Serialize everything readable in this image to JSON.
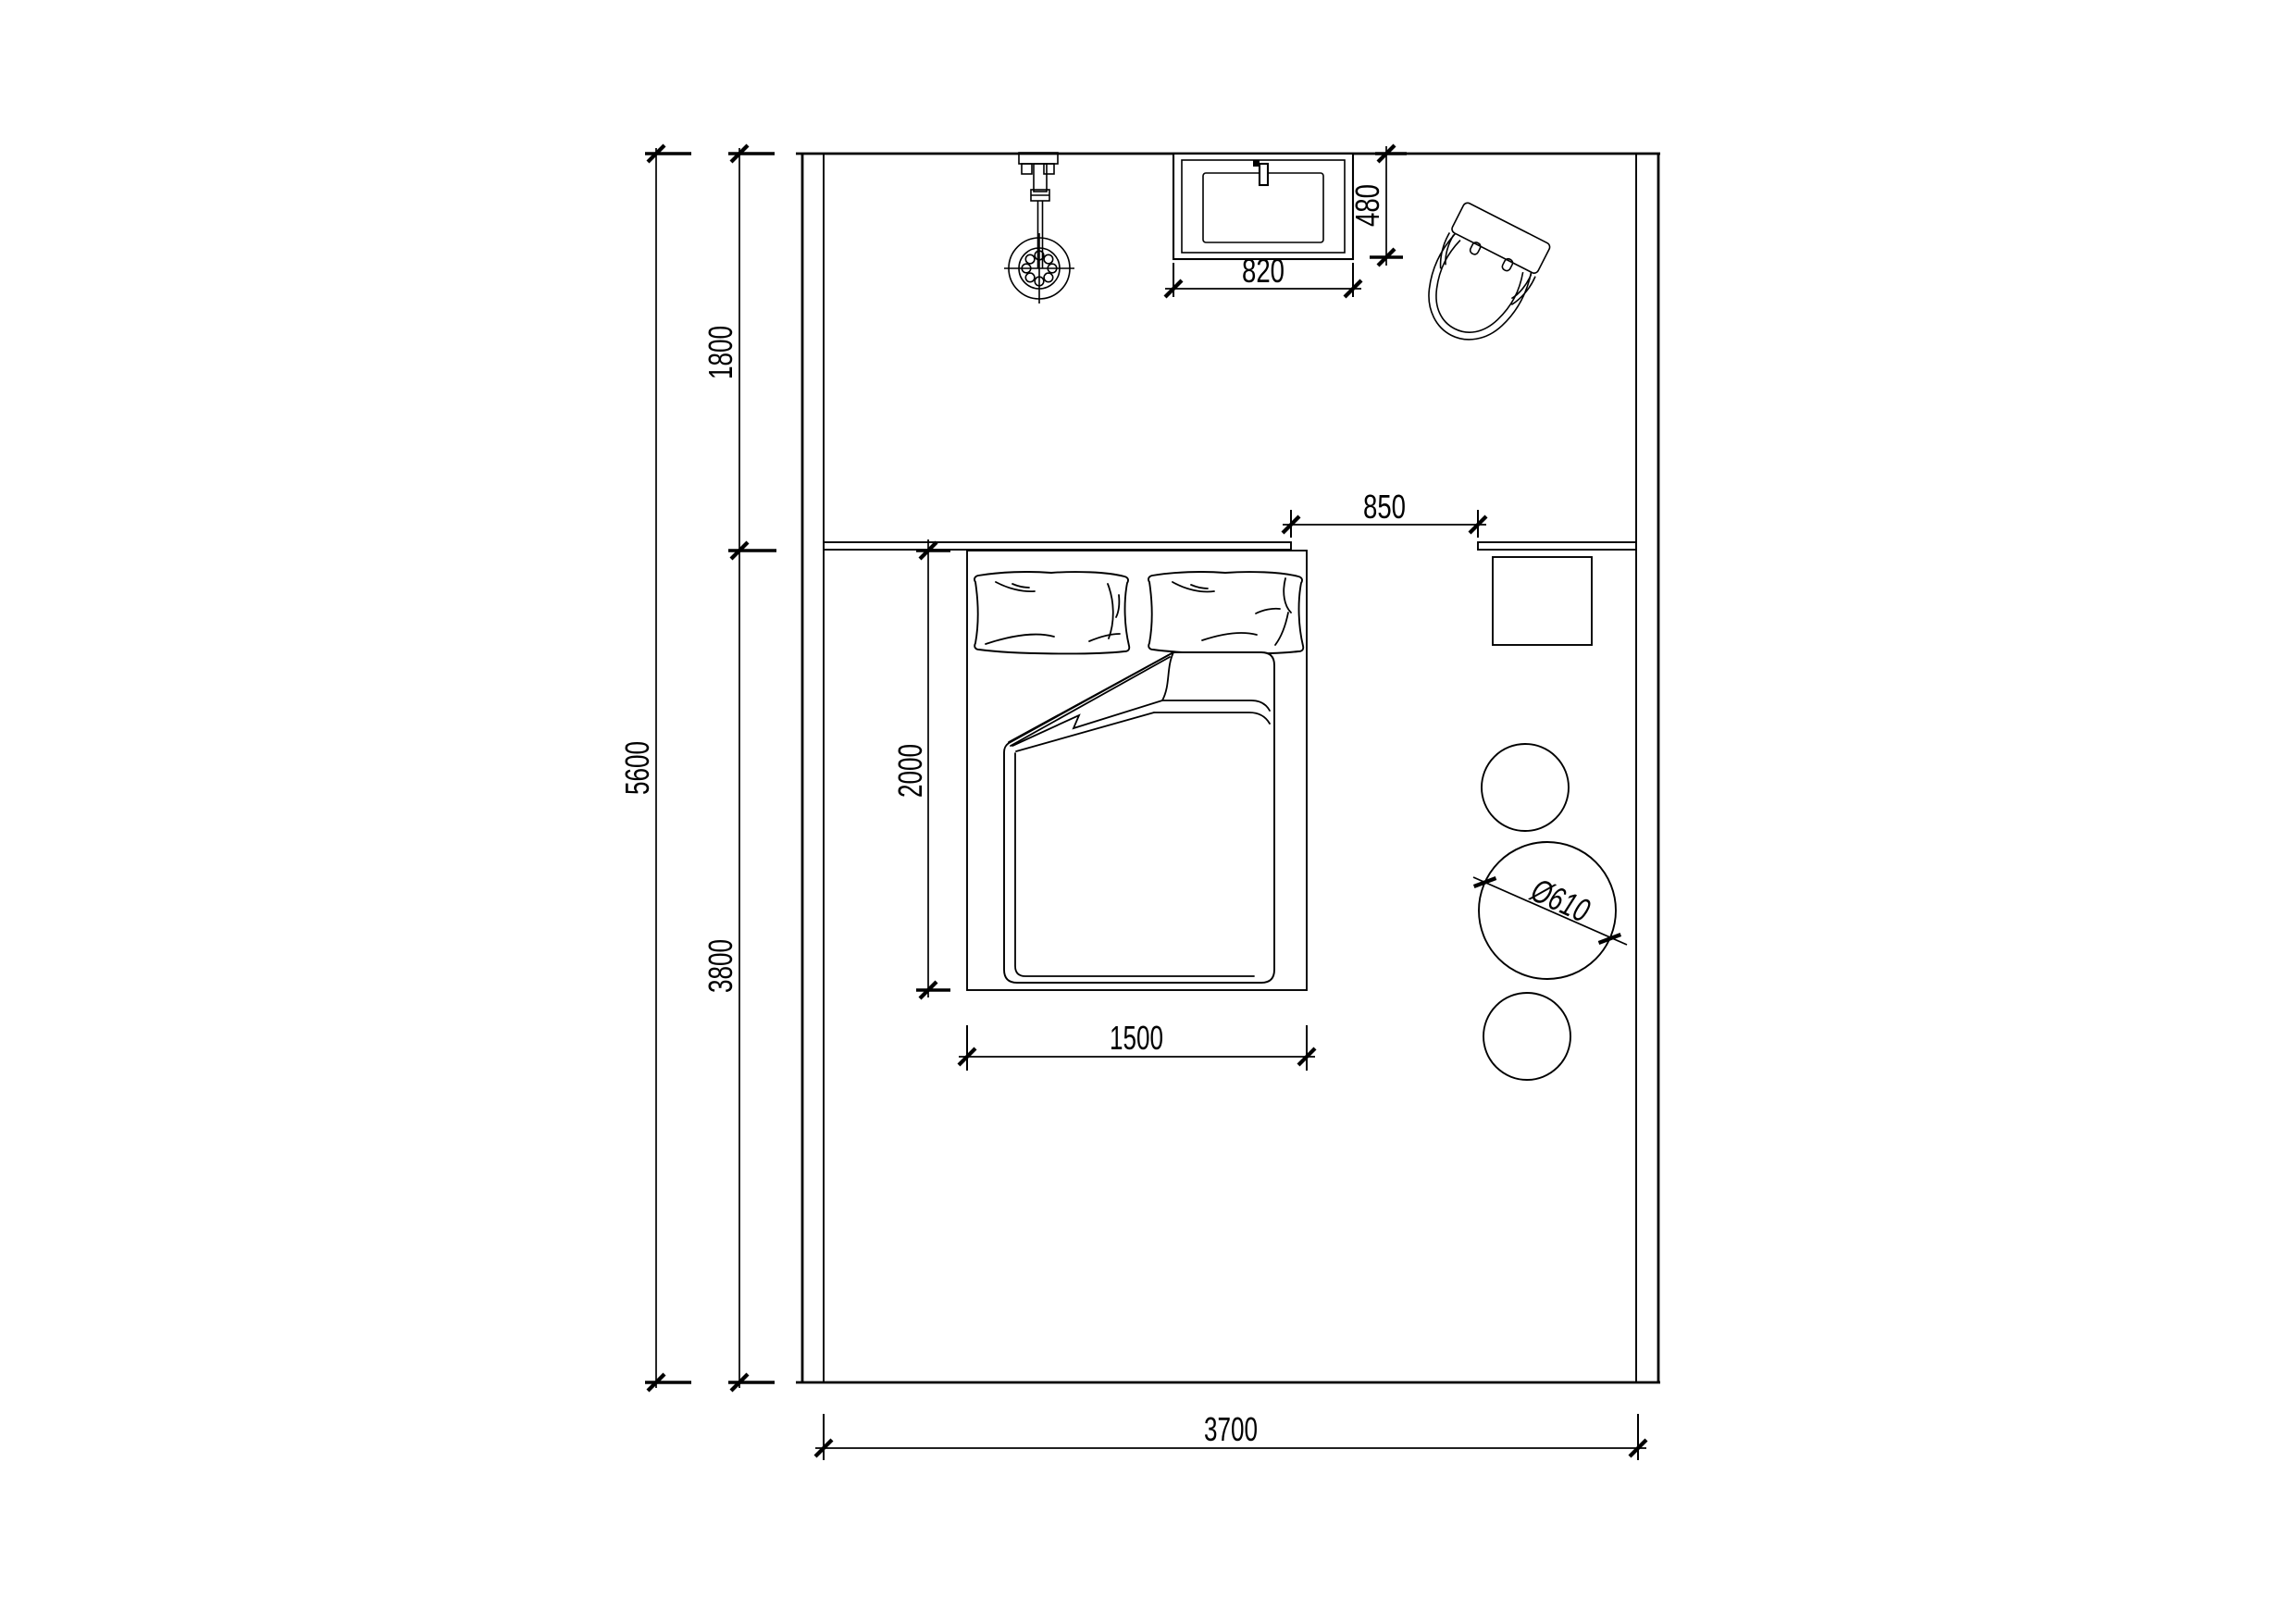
{
  "meta": {
    "drawing_type": "bedroom floor plan",
    "units": "mm"
  },
  "colors": {
    "background": "#ffffff",
    "line": "#000000"
  },
  "labels": {
    "room_total_depth": "5600",
    "zone_top_depth": "1800",
    "zone_bottom_depth": "3800",
    "room_width": "3700",
    "bed_length": "2000",
    "bed_width": "1500",
    "bed_to_ledge_gap": "850",
    "basin_width": "820",
    "basin_depth": "480",
    "table_diameter": "Ø610"
  },
  "fixtures": {
    "shower": "shower-head",
    "basin": "wash-basin",
    "toilet": "toilet",
    "bed": "double-bed",
    "pillows": "two-pillows",
    "blanket": "folded-blanket",
    "desk": "side-table",
    "round_table": "round-table",
    "stools": "two-stools",
    "ledges": "headboard-ledge"
  }
}
